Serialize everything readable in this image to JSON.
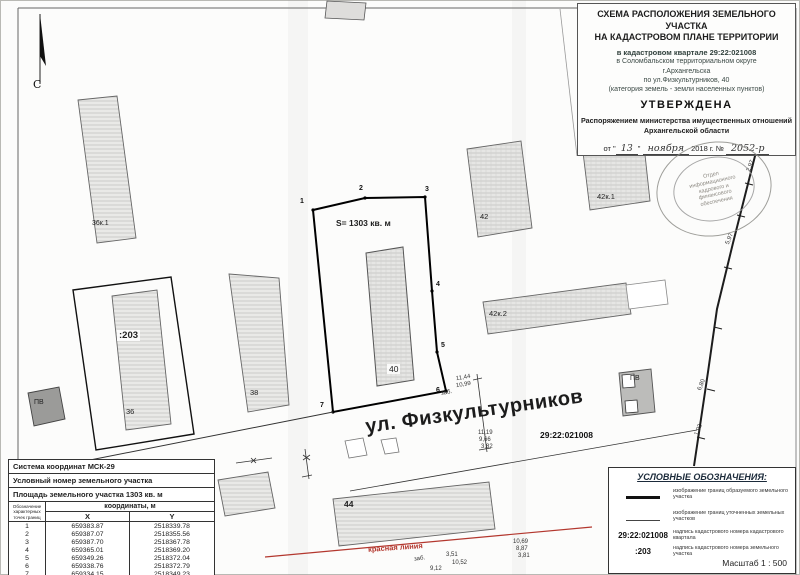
{
  "north_label": "С",
  "title_block": {
    "line1": "СХЕМА РАСПОЛОЖЕНИЯ ЗЕМЕЛЬНОГО УЧАСТКА",
    "line2": "НА КАДАСТРОВОМ ПЛАНЕ ТЕРРИТОРИИ",
    "quarter": "в кадастровом квартале 29:22:021008",
    "district": "в  Соломбальском территориальном округе",
    "city": "г.Архангельска",
    "street": "по ул.Физкультурников, 40",
    "category": "(категория земель - земли населенных пунктов)",
    "approved": "УТВЕРЖДЕНА",
    "order_line1": "Распоряжением министерства имущественных отношений",
    "order_line2": "Архангельской области",
    "date_prefix": "от \"",
    "date_day": "13",
    "date_mid": "\"",
    "date_month": "ноября",
    "date_rest": "2018 г. №",
    "order_number": "2052-р"
  },
  "stamp": {
    "line1": "Отдел",
    "line2": "информационного",
    "line3": "кадрового и",
    "line4": "финансового",
    "line5": "обеспечения"
  },
  "map": {
    "area_label": "S= 1303 кв. м",
    "street_label": "ул. Физкультурников",
    "red_line_label": "красная линия",
    "quarter_label": "29:22:021008",
    "buildings": {
      "b36k1": "36к.1",
      "plot203": ":203",
      "b36": "36",
      "b38": "38",
      "b40": "40",
      "b42": "42",
      "b42k1": "42к.1",
      "b42k2": "42к.2",
      "b44": "44",
      "pv_left": "ПВ",
      "pv_right": "ПВ"
    },
    "vertices": [
      "1",
      "2",
      "3",
      "4",
      "5",
      "6",
      "7"
    ],
    "measurements": {
      "m1": "2,97",
      "m2": "5,97",
      "m3": "6,80",
      "m4": "1,92",
      "m5": "11,44",
      "m6": "10,99",
      "m7": "11,19",
      "m8": "9,66",
      "m9": "3,82",
      "m10": "3,51",
      "m11": "10,52",
      "m12": "9,12",
      "m13": "10,69",
      "m14": "8,87",
      "m15": "3,81",
      "fence1": "заб.",
      "fence2": "заб."
    }
  },
  "coord_table": {
    "coord_system": "Система координат МСК-29",
    "cadastral_label": "Условный номер земельного участка",
    "area_label": "Площадь земельного участка  1303 кв. м",
    "col_points": "Обозначение характерных точек границ",
    "col_coords": "координаты, м",
    "col_x": "X",
    "col_y": "Y",
    "rows": [
      {
        "n": "1",
        "x": "659383.87",
        "y": "2518339.78"
      },
      {
        "n": "2",
        "x": "659387.07",
        "y": "2518355.56"
      },
      {
        "n": "3",
        "x": "659387.70",
        "y": "2518367.78"
      },
      {
        "n": "4",
        "x": "659365.01",
        "y": "2518369.20"
      },
      {
        "n": "5",
        "x": "659349.26",
        "y": "2518372.04"
      },
      {
        "n": "6",
        "x": "659338.76",
        "y": "2518372.79"
      },
      {
        "n": "7",
        "x": "659334.15",
        "y": "2518349.23"
      }
    ]
  },
  "legend": {
    "title": "УСЛОВНЫЕ ОБОЗНАЧЕНИЯ:",
    "items": [
      {
        "sample": "",
        "text": "изображение границ образуемого земельного участка"
      },
      {
        "sample": "",
        "text": "изображение границ уточненных земельных участков"
      },
      {
        "sample": "29:22:021008",
        "text": "надпись кадастрового номера кадастрового квартала"
      },
      {
        "sample": ":203",
        "text": "надпись кадастрового номера земельного участка"
      }
    ],
    "scale": "Масштаб  1 : 500"
  }
}
